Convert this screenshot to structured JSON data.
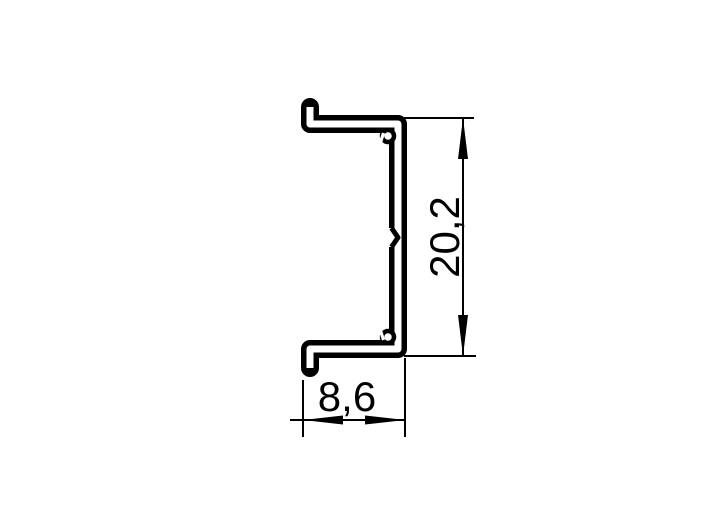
{
  "drawing": {
    "kind": "profile-cross-section-technical-drawing",
    "background_color": "#ffffff",
    "line_color": "#000000",
    "dimensions": {
      "height": {
        "value": "20,2",
        "orientation": "vertical",
        "side": "right"
      },
      "width": {
        "value": "8,6",
        "orientation": "horizontal",
        "side": "bottom"
      }
    }
  }
}
